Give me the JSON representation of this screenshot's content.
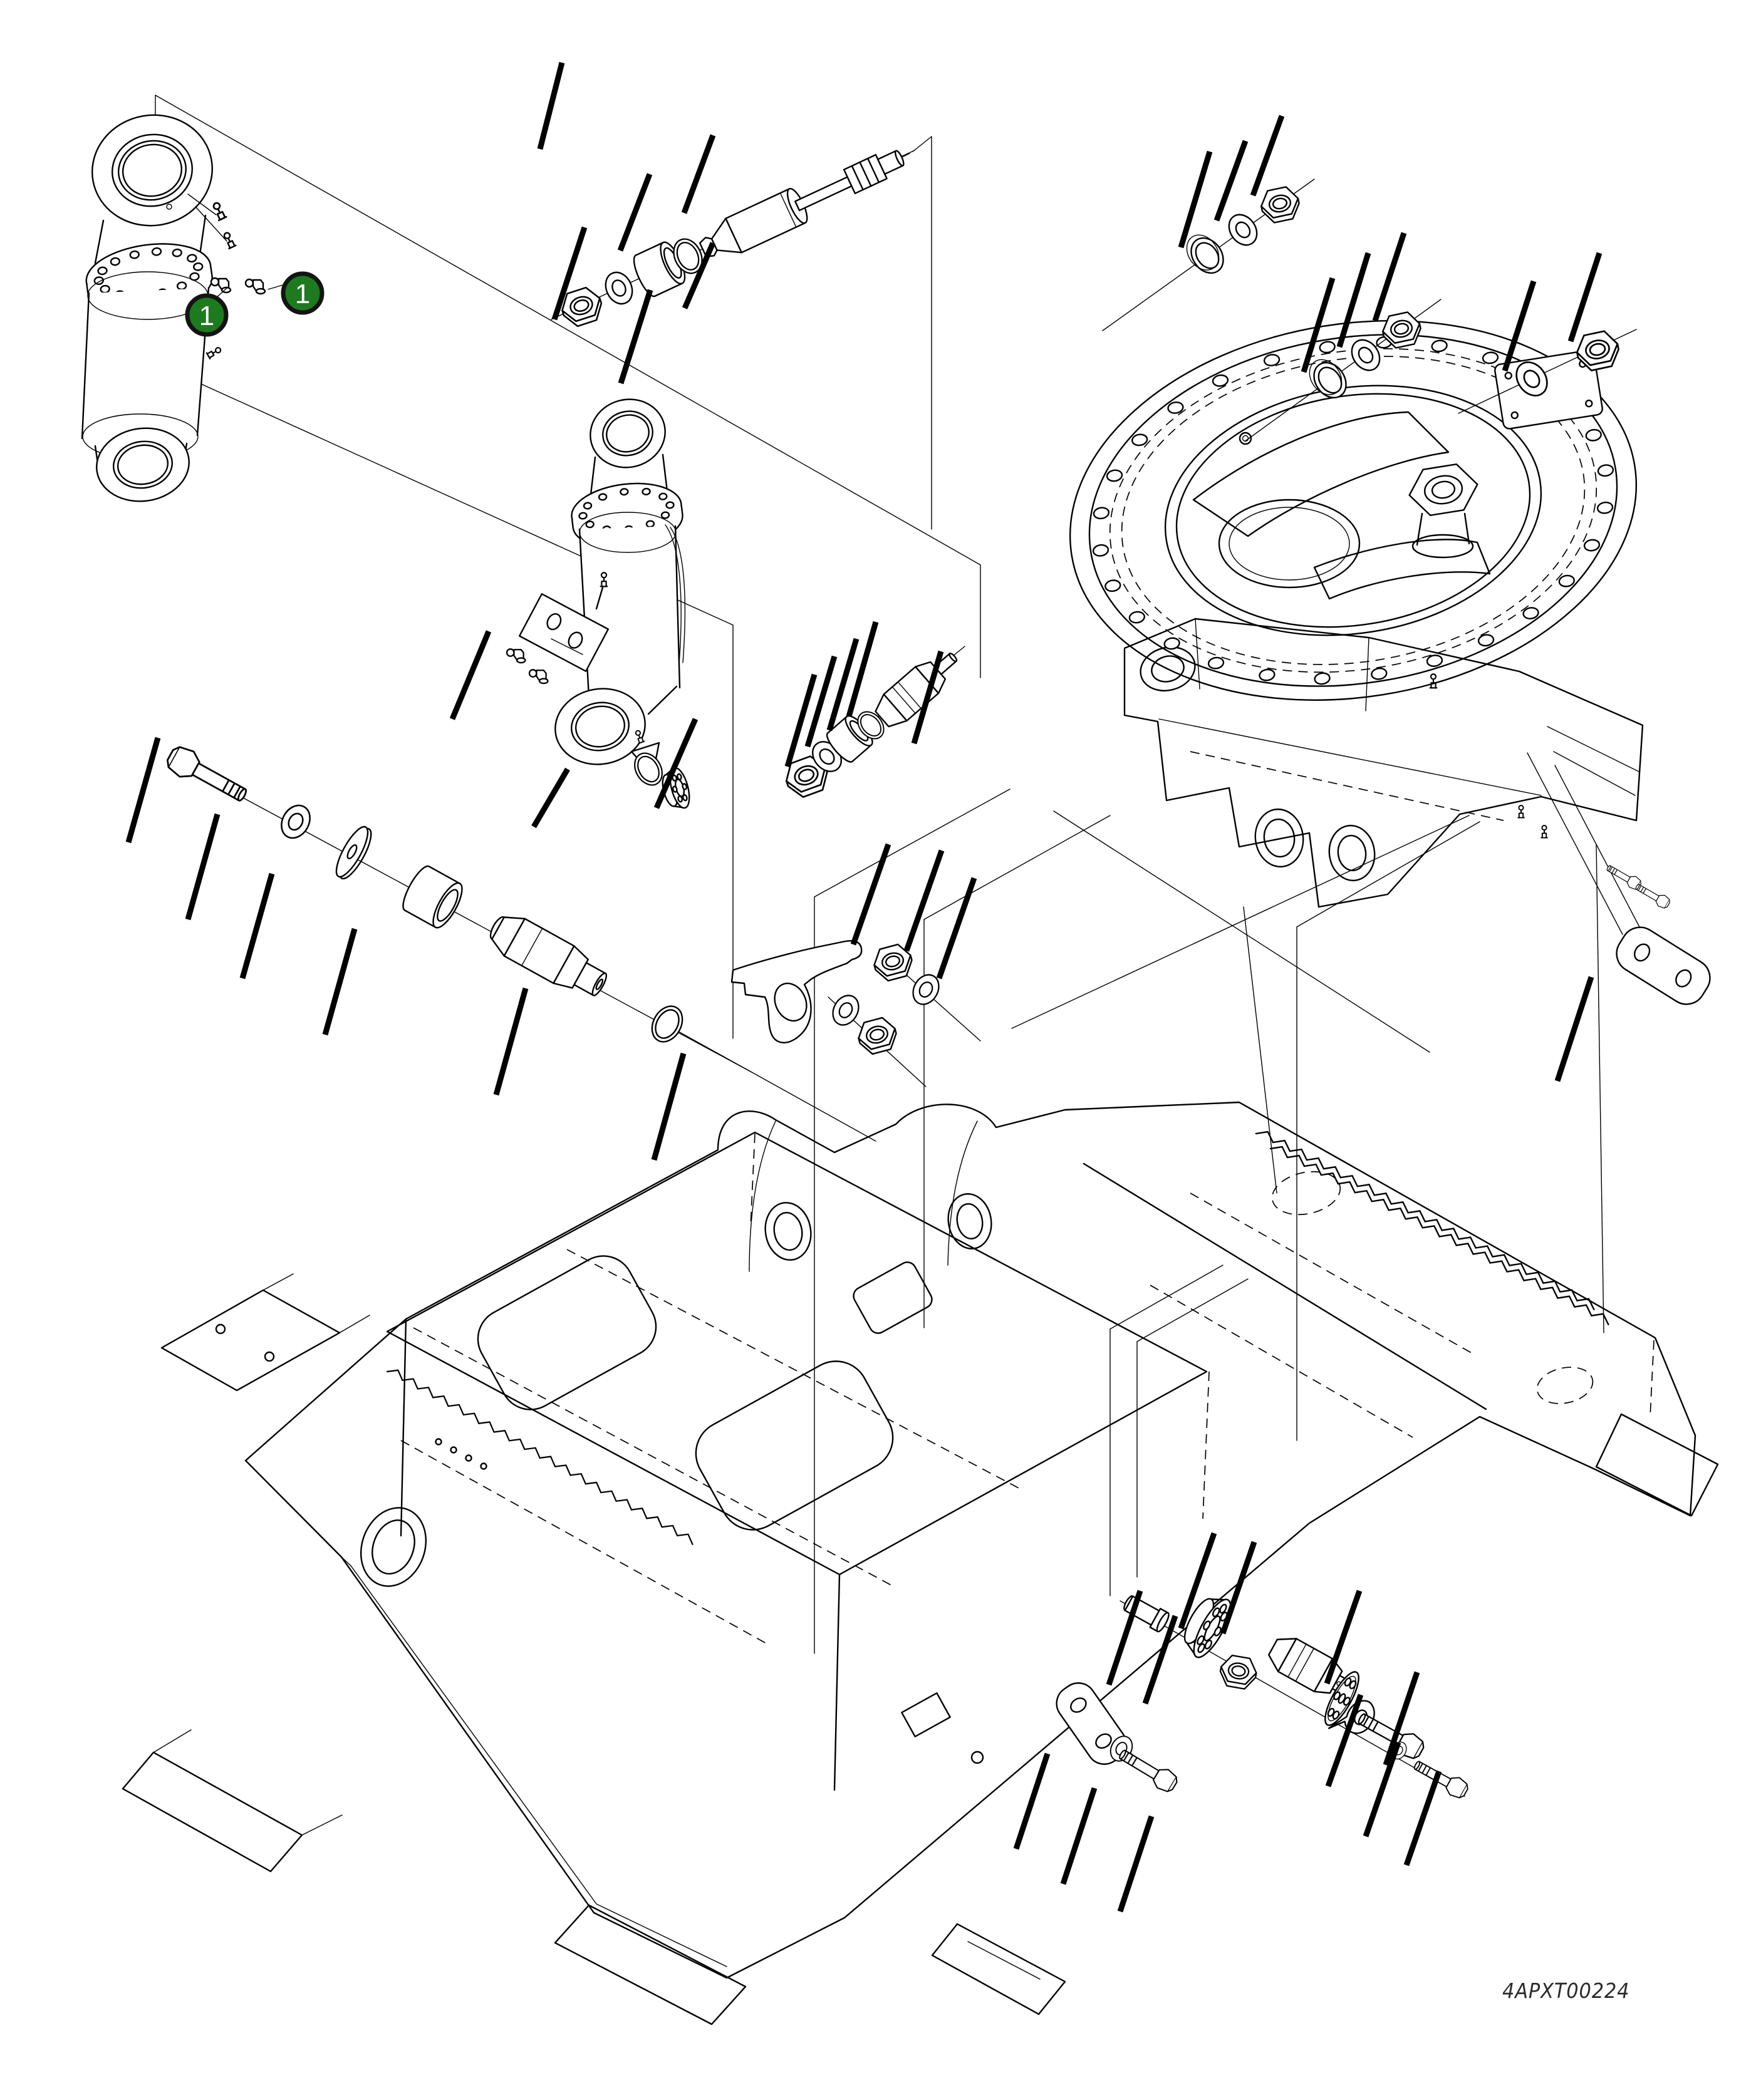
{
  "figure": {
    "kind": "exploded-parts-diagram",
    "drawing_number": "4APXT00224"
  },
  "callouts": {
    "balloon_a": {
      "label": "1"
    },
    "balloon_b": {
      "label": "1"
    }
  },
  "colors": {
    "balloon_fill": "#1e7a1e",
    "balloon_ring": "#141414",
    "balloon_text": "#ffffff",
    "line": "#000000",
    "background": "#ffffff"
  }
}
